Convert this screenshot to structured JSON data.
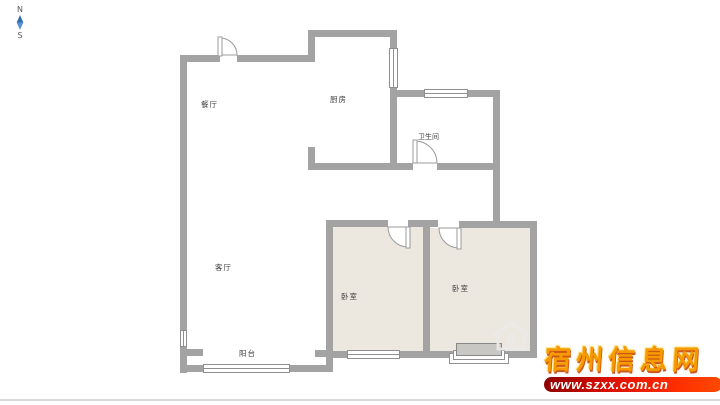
{
  "compass": {
    "north": "N",
    "south": "S"
  },
  "rooms": {
    "dining": {
      "label": "餐厅"
    },
    "kitchen": {
      "label": "厨房"
    },
    "bathroom": {
      "label": "卫生间"
    },
    "living": {
      "label": "客厅"
    },
    "bedroom_left": {
      "label": "卧室"
    },
    "bedroom_right": {
      "label": "卧室"
    },
    "balcony": {
      "label": "阳台"
    }
  },
  "watermark": {
    "site_name": "宿州信息网",
    "site_url": "www.szxx.com.cn"
  },
  "colors": {
    "wall": "#a3a3a4",
    "room_fill": "#ece7df",
    "compass_blue": "#3f74b5",
    "brand_gold": "#f59b00",
    "brand_band_red": "#d90e00"
  }
}
